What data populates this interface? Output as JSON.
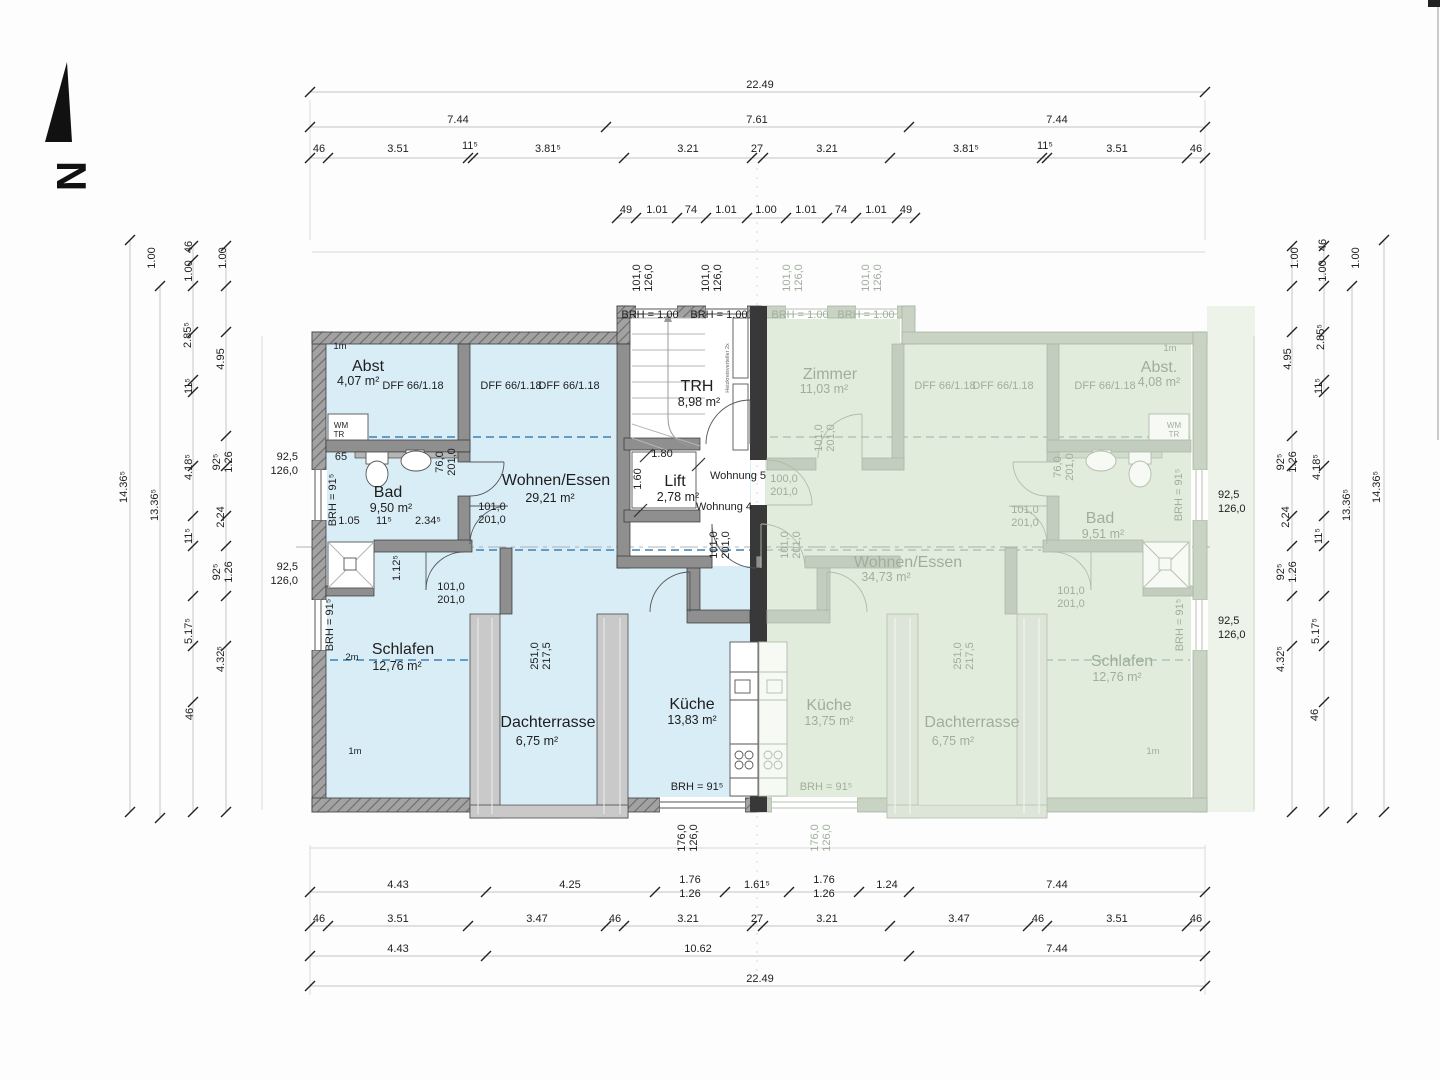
{
  "document": {
    "type": "floor-plan-scan",
    "units_shown": [
      "Wohnung 4",
      "Wohnung 5"
    ],
    "shared_areas": [
      "TRH",
      "Lift"
    ],
    "north_arrow": "N"
  },
  "colors": {
    "left_apartment_fill": "#d9edf6",
    "right_apartment_fill": "#e2ecdd",
    "wall_dark": "#383838",
    "dashed_roofline": "#3e82b8",
    "faded_text": "#9fae9c"
  },
  "apartments": {
    "left": {
      "label": "Wohnung 4",
      "rooms": [
        {
          "name": "Abst",
          "area": "4,07 m²"
        },
        {
          "name": "Bad",
          "area": "9,50 m²"
        },
        {
          "name": "Wohnen/Essen",
          "area": "29,21 m²"
        },
        {
          "name": "Schlafen",
          "area": "12,76 m²"
        },
        {
          "name": "Dachterrasse",
          "area": "6,75 m²"
        },
        {
          "name": "Küche",
          "area": "13,83 m²"
        }
      ]
    },
    "right": {
      "label": "Wohnung 5",
      "rooms": [
        {
          "name": "Zimmer",
          "area": "11,03 m²"
        },
        {
          "name": "Abst.",
          "area": "4,08 m²"
        },
        {
          "name": "Bad",
          "area": "9,51 m²"
        },
        {
          "name": "Wohnen/Essen",
          "area": "34,73 m²"
        },
        {
          "name": "Küche",
          "area": "13,75 m²"
        },
        {
          "name": "Dachterrasse",
          "area": "6,75 m²"
        },
        {
          "name": "Schlafen",
          "area": "12,76 m²"
        }
      ]
    },
    "shared": [
      {
        "name": "TRH",
        "area": "8,98 m²"
      },
      {
        "name": "Lift",
        "area": "2,78 m²"
      }
    ]
  },
  "labels": [
    {
      "t": "N",
      "x": 57,
      "y": 176,
      "r": 90,
      "c": "north",
      "n": "north-letter"
    },
    {
      "t": "22.49",
      "x": 760,
      "y": 88,
      "n": "dim-total-top"
    },
    {
      "t": "7.44",
      "x": 458,
      "y": 123
    },
    {
      "t": "7.61",
      "x": 757,
      "y": 123
    },
    {
      "t": "7.44",
      "x": 1057,
      "y": 123
    },
    {
      "t": "46",
      "x": 319,
      "y": 152
    },
    {
      "t": "3.51",
      "x": 398,
      "y": 152
    },
    {
      "t": "11⁵",
      "x": 470,
      "y": 149
    },
    {
      "t": "3.81⁵",
      "x": 548,
      "y": 152
    },
    {
      "t": "3.21",
      "x": 688,
      "y": 152
    },
    {
      "t": "27",
      "x": 757,
      "y": 152
    },
    {
      "t": "3.21",
      "x": 827,
      "y": 152
    },
    {
      "t": "3.81⁵",
      "x": 966,
      "y": 152
    },
    {
      "t": "11⁵",
      "x": 1045,
      "y": 149
    },
    {
      "t": "3.51",
      "x": 1117,
      "y": 152
    },
    {
      "t": "46",
      "x": 1196,
      "y": 152
    },
    {
      "t": "49",
      "x": 626,
      "y": 213
    },
    {
      "t": "1.01",
      "x": 657,
      "y": 213
    },
    {
      "t": "74",
      "x": 691,
      "y": 213
    },
    {
      "t": "1.01",
      "x": 726,
      "y": 213
    },
    {
      "t": "1.00",
      "x": 766,
      "y": 213
    },
    {
      "t": "1.01",
      "x": 806,
      "y": 213
    },
    {
      "t": "74",
      "x": 841,
      "y": 213
    },
    {
      "t": "1.01",
      "x": 876,
      "y": 213
    },
    {
      "t": "49",
      "x": 906,
      "y": 213
    },
    {
      "t": "4.43",
      "x": 398,
      "y": 888
    },
    {
      "t": "4.25",
      "x": 570,
      "y": 888
    },
    {
      "t": "1.76",
      "x": 690,
      "y": 883
    },
    {
      "t": "1.26",
      "x": 690,
      "y": 897
    },
    {
      "t": "1.61⁵",
      "x": 757,
      "y": 888
    },
    {
      "t": "1.76",
      "x": 824,
      "y": 883
    },
    {
      "t": "1.26",
      "x": 824,
      "y": 897
    },
    {
      "t": "1.24",
      "x": 887,
      "y": 888
    },
    {
      "t": "7.44",
      "x": 1057,
      "y": 888
    },
    {
      "t": "46",
      "x": 319,
      "y": 922
    },
    {
      "t": "3.51",
      "x": 398,
      "y": 922
    },
    {
      "t": "3.47",
      "x": 537,
      "y": 922
    },
    {
      "t": "46",
      "x": 615,
      "y": 922
    },
    {
      "t": "3.21",
      "x": 688,
      "y": 922
    },
    {
      "t": "27",
      "x": 757,
      "y": 922
    },
    {
      "t": "3.21",
      "x": 827,
      "y": 922
    },
    {
      "t": "3.47",
      "x": 959,
      "y": 922
    },
    {
      "t": "46",
      "x": 1038,
      "y": 922
    },
    {
      "t": "3.51",
      "x": 1117,
      "y": 922
    },
    {
      "t": "46",
      "x": 1196,
      "y": 922
    },
    {
      "t": "4.43",
      "x": 398,
      "y": 952
    },
    {
      "t": "10.62",
      "x": 698,
      "y": 952
    },
    {
      "t": "7.44",
      "x": 1057,
      "y": 952
    },
    {
      "t": "22.49",
      "x": 760,
      "y": 982,
      "n": "dim-total-bottom"
    },
    {
      "t": "1.00",
      "x": 155,
      "y": 258,
      "r": -90
    },
    {
      "t": "46",
      "x": 192,
      "y": 247,
      "r": -90
    },
    {
      "t": "1.00",
      "x": 192,
      "y": 271,
      "r": -90
    },
    {
      "t": "1.00",
      "x": 226,
      "y": 258,
      "r": -90
    },
    {
      "t": "2.85⁵",
      "x": 191,
      "y": 335,
      "r": -90
    },
    {
      "t": "4.95",
      "x": 224,
      "y": 359,
      "r": -90
    },
    {
      "t": "11⁵",
      "x": 192,
      "y": 386,
      "r": -90
    },
    {
      "t": "14.36⁵",
      "x": 127,
      "y": 487,
      "r": -90
    },
    {
      "t": "13.36⁵",
      "x": 158,
      "y": 505,
      "r": -90
    },
    {
      "t": "92⁵",
      "x": 220,
      "y": 462,
      "r": -90
    },
    {
      "t": "1.26",
      "x": 232,
      "y": 462,
      "r": -90
    },
    {
      "t": "4.18⁵",
      "x": 192,
      "y": 467,
      "r": -90
    },
    {
      "t": "2.24",
      "x": 224,
      "y": 517,
      "r": -90
    },
    {
      "t": "11⁵",
      "x": 192,
      "y": 536,
      "r": -90
    },
    {
      "t": "92⁵",
      "x": 220,
      "y": 572,
      "r": -90
    },
    {
      "t": "1.26",
      "x": 232,
      "y": 572,
      "r": -90
    },
    {
      "t": "5.17⁵",
      "x": 192,
      "y": 631,
      "r": -90
    },
    {
      "t": "4.32⁵",
      "x": 224,
      "y": 659,
      "r": -90
    },
    {
      "t": "46",
      "x": 193,
      "y": 714,
      "r": -90
    },
    {
      "t": "1.00",
      "x": 1298,
      "y": 258,
      "r": -90
    },
    {
      "t": "46",
      "x": 1326,
      "y": 245,
      "r": -90
    },
    {
      "t": "1.00",
      "x": 1326,
      "y": 271,
      "r": -90
    },
    {
      "t": "1.00",
      "x": 1359,
      "y": 258,
      "r": -90
    },
    {
      "t": "2.85⁵",
      "x": 1324,
      "y": 337,
      "r": -90
    },
    {
      "t": "4.95",
      "x": 1291,
      "y": 359,
      "r": -90
    },
    {
      "t": "11⁵",
      "x": 1322,
      "y": 386,
      "r": -90
    },
    {
      "t": "92⁵",
      "x": 1284,
      "y": 462,
      "r": -90
    },
    {
      "t": "1.26",
      "x": 1296,
      "y": 462,
      "r": -90
    },
    {
      "t": "4.18⁵",
      "x": 1320,
      "y": 467,
      "r": -90
    },
    {
      "t": "13.36⁵",
      "x": 1350,
      "y": 505,
      "r": -90
    },
    {
      "t": "14.36⁵",
      "x": 1380,
      "y": 487,
      "r": -90
    },
    {
      "t": "2.24",
      "x": 1289,
      "y": 517,
      "r": -90
    },
    {
      "t": "11⁵",
      "x": 1322,
      "y": 536,
      "r": -90
    },
    {
      "t": "92⁵",
      "x": 1284,
      "y": 572,
      "r": -90
    },
    {
      "t": "1.26",
      "x": 1296,
      "y": 572,
      "r": -90
    },
    {
      "t": "5.17⁵",
      "x": 1319,
      "y": 631,
      "r": -90
    },
    {
      "t": "4.32⁵",
      "x": 1284,
      "y": 659,
      "r": -90
    },
    {
      "t": "46",
      "x": 1318,
      "y": 715,
      "r": -90
    },
    {
      "t": "92,5",
      "x": 298,
      "y": 460,
      "a": "end",
      "c": "lab"
    },
    {
      "t": "126,0",
      "x": 298,
      "y": 474,
      "a": "end",
      "c": "lab"
    },
    {
      "t": "92,5",
      "x": 298,
      "y": 570,
      "a": "end",
      "c": "lab"
    },
    {
      "t": "126,0",
      "x": 298,
      "y": 584,
      "a": "end",
      "c": "lab"
    },
    {
      "t": "92,5",
      "x": 1218,
      "y": 498,
      "a": "start",
      "c": "lab"
    },
    {
      "t": "126,0",
      "x": 1218,
      "y": 512,
      "a": "start",
      "c": "lab"
    },
    {
      "t": "92,5",
      "x": 1218,
      "y": 624,
      "a": "start",
      "c": "lab"
    },
    {
      "t": "126,0",
      "x": 1218,
      "y": 638,
      "a": "start",
      "c": "lab"
    },
    {
      "t": "101,0",
      "x": 640,
      "y": 278,
      "r": -90,
      "c": "lab"
    },
    {
      "t": "126,0",
      "x": 652,
      "y": 278,
      "r": -90,
      "c": "lab"
    },
    {
      "t": "101,0",
      "x": 709,
      "y": 278,
      "r": -90,
      "c": "lab"
    },
    {
      "t": "126,0",
      "x": 721,
      "y": 278,
      "r": -90,
      "c": "lab"
    },
    {
      "t": "101,0",
      "x": 790,
      "y": 278,
      "r": -90,
      "c": "lab",
      "f": 1
    },
    {
      "t": "126,0",
      "x": 802,
      "y": 278,
      "r": -90,
      "c": "lab",
      "f": 1
    },
    {
      "t": "101,0",
      "x": 869,
      "y": 278,
      "r": -90,
      "c": "lab",
      "f": 1
    },
    {
      "t": "126,0",
      "x": 881,
      "y": 278,
      "r": -90,
      "c": "lab",
      "f": 1
    },
    {
      "t": "176,0",
      "x": 685,
      "y": 838,
      "r": -90,
      "c": "lab"
    },
    {
      "t": "126,0",
      "x": 697,
      "y": 838,
      "r": -90,
      "c": "lab"
    },
    {
      "t": "176,0",
      "x": 818,
      "y": 838,
      "r": -90,
      "c": "lab",
      "f": 1
    },
    {
      "t": "126,0",
      "x": 830,
      "y": 838,
      "r": -90,
      "c": "lab",
      "f": 1
    },
    {
      "t": "BRH = 1.00",
      "x": 650,
      "y": 318,
      "c": "lab"
    },
    {
      "t": "BRH = 1.00",
      "x": 719,
      "y": 318,
      "c": "lab"
    },
    {
      "t": "BRH = 1.00",
      "x": 800,
      "y": 318,
      "c": "lab",
      "f": 1
    },
    {
      "t": "BRH = 1.00",
      "x": 866,
      "y": 318,
      "c": "lab",
      "f": 1
    },
    {
      "t": "BRH = 91⁵",
      "x": 697,
      "y": 790,
      "c": "lab"
    },
    {
      "t": "BRH = 91⁵",
      "x": 826,
      "y": 790,
      "c": "lab",
      "f": 1
    },
    {
      "t": "BRH = 91⁵",
      "x": 336,
      "y": 500,
      "r": -90,
      "c": "lab"
    },
    {
      "t": "BRH = 91⁵",
      "x": 333,
      "y": 625,
      "r": -90,
      "c": "lab"
    },
    {
      "t": "BRH = 91⁵",
      "x": 1182,
      "y": 495,
      "r": -90,
      "c": "lab",
      "f": 1
    },
    {
      "t": "BRH = 91⁵",
      "x": 1183,
      "y": 625,
      "r": -90,
      "c": "lab",
      "f": 1
    },
    {
      "t": "Abst",
      "x": 352,
      "y": 371,
      "c": "room",
      "a": "start",
      "n": "room-abst-left"
    },
    {
      "t": "4,07 m²",
      "x": 337,
      "y": 385,
      "c": "area",
      "a": "start"
    },
    {
      "t": "1m",
      "x": 340,
      "y": 349,
      "c": "sm"
    },
    {
      "t": "1m",
      "x": 355,
      "y": 754,
      "c": "sm"
    },
    {
      "t": "2m",
      "x": 352,
      "y": 660,
      "c": "sm"
    },
    {
      "t": "DFF  66/1.18",
      "x": 413,
      "y": 389,
      "c": "lab"
    },
    {
      "t": "DFF  66/1.18",
      "x": 511,
      "y": 389,
      "c": "lab"
    },
    {
      "t": "DFF  66/1.18",
      "x": 569,
      "y": 389,
      "c": "lab"
    },
    {
      "t": "WM",
      "x": 341,
      "y": 428,
      "c": "xs"
    },
    {
      "t": "TR",
      "x": 339,
      "y": 437,
      "c": "xs"
    },
    {
      "t": "65",
      "x": 341,
      "y": 460
    },
    {
      "t": "Bad",
      "x": 388,
      "y": 497,
      "c": "room",
      "n": "room-bad-left"
    },
    {
      "t": "9,50 m²",
      "x": 391,
      "y": 512,
      "c": "area"
    },
    {
      "t": "1.05",
      "x": 349,
      "y": 524
    },
    {
      "t": "11⁵",
      "x": 384,
      "y": 524
    },
    {
      "t": "2.34⁵",
      "x": 428,
      "y": 524
    },
    {
      "t": "76,0",
      "x": 443,
      "y": 462,
      "r": -90,
      "c": "lab"
    },
    {
      "t": "201,0",
      "x": 455,
      "y": 462,
      "r": -90,
      "c": "lab"
    },
    {
      "t": "101,0",
      "x": 492,
      "y": 510,
      "c": "lab"
    },
    {
      "t": "201,0",
      "x": 492,
      "y": 523,
      "c": "lab"
    },
    {
      "t": "101,0",
      "x": 451,
      "y": 590,
      "c": "lab"
    },
    {
      "t": "201,0",
      "x": 451,
      "y": 603,
      "c": "lab"
    },
    {
      "t": "1.12⁵",
      "x": 400,
      "y": 568,
      "r": -90
    },
    {
      "t": "Wohnen/Essen",
      "x": 556,
      "y": 485,
      "c": "room",
      "n": "room-wohnen-left"
    },
    {
      "t": "29,21 m²",
      "x": 550,
      "y": 502,
      "c": "area"
    },
    {
      "t": "Schlafen",
      "x": 403,
      "y": 654,
      "c": "room",
      "n": "room-schlafen-left"
    },
    {
      "t": "12,76 m²",
      "x": 397,
      "y": 670,
      "c": "area"
    },
    {
      "t": "Dachterrasse",
      "x": 548,
      "y": 727,
      "c": "room",
      "n": "room-dachterrasse-left"
    },
    {
      "t": "6,75 m²",
      "x": 537,
      "y": 745,
      "c": "area"
    },
    {
      "t": "Küche",
      "x": 692,
      "y": 709,
      "c": "room",
      "n": "room-kueche-left"
    },
    {
      "t": "13,83 m²",
      "x": 692,
      "y": 724,
      "c": "area"
    },
    {
      "t": "251,0",
      "x": 538,
      "y": 656,
      "r": -90,
      "c": "lab"
    },
    {
      "t": "217,5",
      "x": 550,
      "y": 656,
      "r": -90,
      "c": "lab"
    },
    {
      "t": "TRH",
      "x": 697,
      "y": 391,
      "c": "room",
      "n": "room-trh"
    },
    {
      "t": "8,98 m²",
      "x": 699,
      "y": 406,
      "c": "area"
    },
    {
      "t": "Lift",
      "x": 675,
      "y": 486,
      "c": "room",
      "n": "room-lift"
    },
    {
      "t": "2,78 m²",
      "x": 678,
      "y": 501,
      "c": "area"
    },
    {
      "t": "1.80",
      "x": 662,
      "y": 457
    },
    {
      "t": "1.60",
      "x": 641,
      "y": 479,
      "r": -90
    },
    {
      "t": "Wohnung 5",
      "x": 738,
      "y": 479,
      "c": "wo",
      "n": "unit-label-wohnung5"
    },
    {
      "t": "Wohnung 4",
      "x": 724,
      "y": 510,
      "c": "wo",
      "n": "unit-label-wohnung4"
    },
    {
      "t": "101,0",
      "x": 717,
      "y": 545,
      "r": -90,
      "c": "lab"
    },
    {
      "t": "201,0",
      "x": 729,
      "y": 545,
      "r": -90,
      "c": "lab"
    },
    {
      "t": "Heizkreisverteiler 2x",
      "x": 729,
      "y": 368,
      "r": -90,
      "c": "tiny"
    },
    {
      "t": "Zimmer",
      "x": 830,
      "y": 379,
      "c": "room",
      "f": 1,
      "n": "room-zimmer-right"
    },
    {
      "t": "11,03 m²",
      "x": 824,
      "y": 393,
      "c": "area",
      "f": 1
    },
    {
      "t": "DFF  66/1.18",
      "x": 945,
      "y": 389,
      "c": "lab",
      "f": 1
    },
    {
      "t": "DFF  66/1.18",
      "x": 1003,
      "y": 389,
      "c": "lab",
      "f": 1
    },
    {
      "t": "DFF  66/1.18",
      "x": 1105,
      "y": 389,
      "c": "lab",
      "f": 1
    },
    {
      "t": "Abst.",
      "x": 1159,
      "y": 372,
      "c": "room",
      "f": 1,
      "n": "room-abst-right"
    },
    {
      "t": "4,08 m²",
      "x": 1159,
      "y": 386,
      "c": "area",
      "f": 1
    },
    {
      "t": "1m",
      "x": 1170,
      "y": 351,
      "c": "sm",
      "f": 1
    },
    {
      "t": "1m",
      "x": 1153,
      "y": 754,
      "c": "sm",
      "f": 1
    },
    {
      "t": "WM",
      "x": 1174,
      "y": 428,
      "c": "xs",
      "f": 1
    },
    {
      "t": "TR",
      "x": 1174,
      "y": 437,
      "c": "xs",
      "f": 1
    },
    {
      "t": "100,0",
      "x": 784,
      "y": 482,
      "c": "lab",
      "f": 1
    },
    {
      "t": "201,0",
      "x": 784,
      "y": 495,
      "c": "lab",
      "f": 1
    },
    {
      "t": "101,0",
      "x": 822,
      "y": 438,
      "r": -90,
      "c": "lab",
      "f": 1
    },
    {
      "t": "201,0",
      "x": 834,
      "y": 438,
      "r": -90,
      "c": "lab",
      "f": 1
    },
    {
      "t": "76,0",
      "x": 1061,
      "y": 467,
      "r": -90,
      "c": "lab",
      "f": 1
    },
    {
      "t": "201,0",
      "x": 1073,
      "y": 467,
      "r": -90,
      "c": "lab",
      "f": 1
    },
    {
      "t": "Bad",
      "x": 1100,
      "y": 523,
      "c": "room",
      "f": 1,
      "n": "room-bad-right"
    },
    {
      "t": "9,51 m²",
      "x": 1103,
      "y": 538,
      "c": "area",
      "f": 1
    },
    {
      "t": "Wohnen/Essen",
      "x": 908,
      "y": 567,
      "c": "room",
      "f": 1,
      "n": "room-wohnen-right"
    },
    {
      "t": "34,73 m²",
      "x": 886,
      "y": 581,
      "c": "area",
      "f": 1
    },
    {
      "t": "101,0",
      "x": 1025,
      "y": 513,
      "c": "lab",
      "f": 1
    },
    {
      "t": "201,0",
      "x": 1025,
      "y": 526,
      "c": "lab",
      "f": 1
    },
    {
      "t": "101,0",
      "x": 1071,
      "y": 594,
      "c": "lab",
      "f": 1
    },
    {
      "t": "201,0",
      "x": 1071,
      "y": 607,
      "c": "lab",
      "f": 1
    },
    {
      "t": "101,0",
      "x": 788,
      "y": 545,
      "r": -90,
      "c": "lab",
      "f": 1
    },
    {
      "t": "201,0",
      "x": 800,
      "y": 545,
      "r": -90,
      "c": "lab",
      "f": 1
    },
    {
      "t": "Küche",
      "x": 829,
      "y": 710,
      "c": "room",
      "f": 1,
      "n": "room-kueche-right"
    },
    {
      "t": "13,75 m²",
      "x": 829,
      "y": 725,
      "c": "area",
      "f": 1
    },
    {
      "t": "Dachterrasse",
      "x": 972,
      "y": 727,
      "c": "room",
      "f": 1,
      "n": "room-dachterrasse-right"
    },
    {
      "t": "6,75 m²",
      "x": 953,
      "y": 745,
      "c": "area",
      "f": 1
    },
    {
      "t": "Schlafen",
      "x": 1122,
      "y": 666,
      "c": "room",
      "f": 1,
      "n": "room-schlafen-right"
    },
    {
      "t": "12,76 m²",
      "x": 1117,
      "y": 681,
      "c": "area",
      "f": 1
    },
    {
      "t": "251,0",
      "x": 961,
      "y": 656,
      "r": -90,
      "c": "lab",
      "f": 1
    },
    {
      "t": "217,5",
      "x": 973,
      "y": 656,
      "r": -90,
      "c": "lab",
      "f": 1
    }
  ]
}
